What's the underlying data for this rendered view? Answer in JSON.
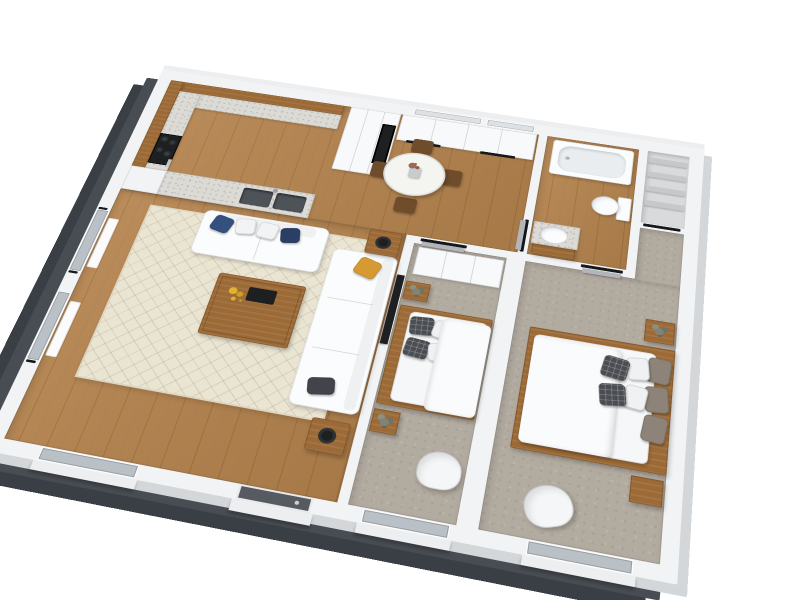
{
  "image_type": "3d-floor-plan-render",
  "background": "#ffffff",
  "colors": {
    "wall_top": "#f2f3f5",
    "exterior_wall_dark": "#484d53",
    "exterior_wall_light": "#d4d7da",
    "wood_floor": "#b5834d",
    "wood_furniture": "#9c6a36",
    "wood_dark": "#6f4c2a",
    "carpet": "#b2aba0",
    "rug": "#eae4d2",
    "counter": "#dcdad5",
    "appliance_black": "#1d1f21",
    "sink_metal": "#4e5358",
    "glass": "#b9c1c7",
    "glass_light": "#dde1e4",
    "entry_door": "#565b61",
    "door_leaf": "#b2b6ba",
    "white_furniture": "#fbfcfd",
    "linen_shelf": "#c6c9cc",
    "pillow_blue": "#33507e",
    "pillow_navy": "#2b3f66",
    "pillow_yellow": "#d79a33",
    "pillow_dark": "#41444a",
    "pillow_taupe": "#8d8378",
    "pillow_plaid": "#4a4d52",
    "flowers_yellow": "#e3b32c",
    "plant_green": "#7e8476",
    "tub_inner": "#e9edef",
    "radiator": "#fbfbfc"
  },
  "scene": {
    "rooms": [
      {
        "name": "kitchen",
        "floor": "wood",
        "items": [
          "upper-cabinet-band",
          "counter",
          "stove",
          "tall-cabinet-oven",
          "peninsula-sink"
        ]
      },
      {
        "name": "dining-hall",
        "floor": "wood",
        "items": [
          "wardrobe-closets",
          "round-dining-table",
          "vase",
          "chair",
          "chair",
          "chair",
          "chair"
        ]
      },
      {
        "name": "bathroom",
        "floor": "wood",
        "items": [
          "bathtub",
          "toilet",
          "vanity-sink",
          "door"
        ]
      },
      {
        "name": "linen-closet",
        "floor": "none",
        "items": [
          "shelf",
          "shelf",
          "shelf",
          "shelf"
        ]
      },
      {
        "name": "living-room",
        "floor": "wood",
        "items": [
          "rug",
          "loveseat",
          "sofa",
          "coffee-table",
          "tray",
          "flowers",
          "side-table",
          "side-table",
          "tv",
          "radiator",
          "radiator"
        ]
      },
      {
        "name": "bedroom-1",
        "floor": "carpet",
        "items": [
          "wardrobe",
          "double-bed",
          "nightstand",
          "nightstand",
          "armchair",
          "plant",
          "plant",
          "door"
        ]
      },
      {
        "name": "bedroom-2",
        "floor": "carpet",
        "items": [
          "double-bed",
          "nightstand",
          "nightstand",
          "armchair",
          "plant",
          "door"
        ]
      }
    ],
    "openings": [
      "west-window",
      "west-window",
      "south-window-living",
      "entry-door",
      "south-window-bedroom-1",
      "south-window-bedroom-2",
      "north-window",
      "north-window"
    ]
  }
}
